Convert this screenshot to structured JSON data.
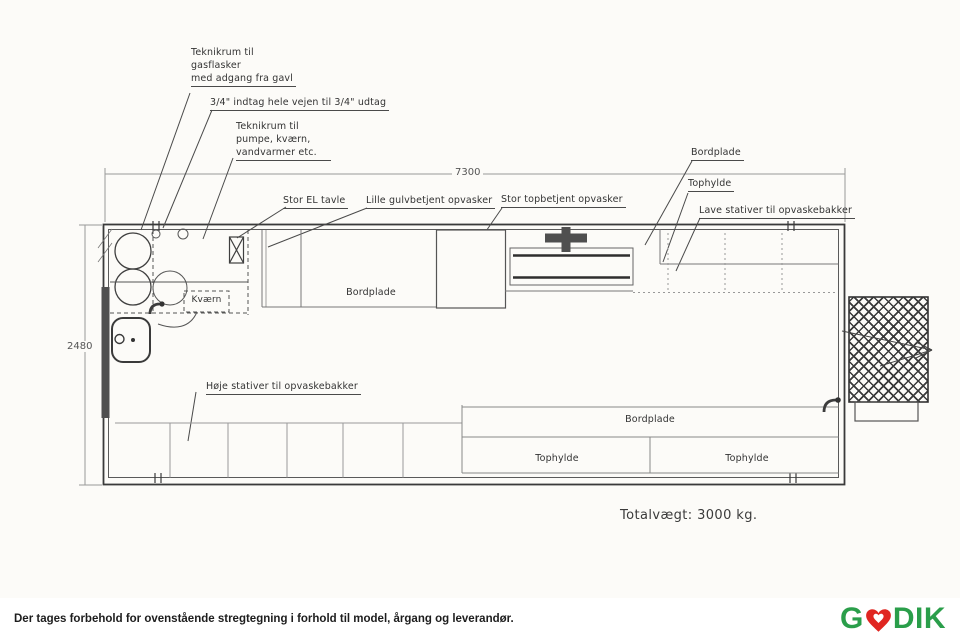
{
  "drawing": {
    "callouts": {
      "gas_room": [
        "Teknikrum til",
        "gasflasker",
        "med adgang fra gavl"
      ],
      "inlet": "3/4\" indtag hele vejen til 3/4\" udtag",
      "pump_room": [
        "Teknikrum til",
        "pumpe, kværn,",
        "vandvarmer etc."
      ],
      "el_panel": "Stor EL tavle",
      "small_dishwasher": "Lille gulvbetjent opvasker",
      "large_dishwasher": "Stor topbetjent opvasker",
      "counter_top_right": "Bordplade",
      "top_shelf_right": "Tophylde",
      "low_racks": "Lave stativer til opvaskebakker",
      "high_racks": "Høje stativer til opvaskebakker",
      "grinder": "Kværn",
      "counter_mid": "Bordplade",
      "counter_bottom": "Bordplade",
      "top_shelf_bottom_left": "Tophylde",
      "top_shelf_bottom_right": "Tophylde"
    },
    "dimensions": {
      "length_mm": "7300",
      "width_mm": "2480"
    },
    "total_weight": "Totalvægt:  3000  kg."
  },
  "footer": {
    "disclaimer": "Der tages forbehold for ovenstående stregtegning i forhold til model, årgang og leverandør.",
    "logo": {
      "part1": "G",
      "part2": "DIK",
      "heart_icon": "heart-icon",
      "green": "#2a9e4a",
      "red": "#e02621"
    }
  }
}
